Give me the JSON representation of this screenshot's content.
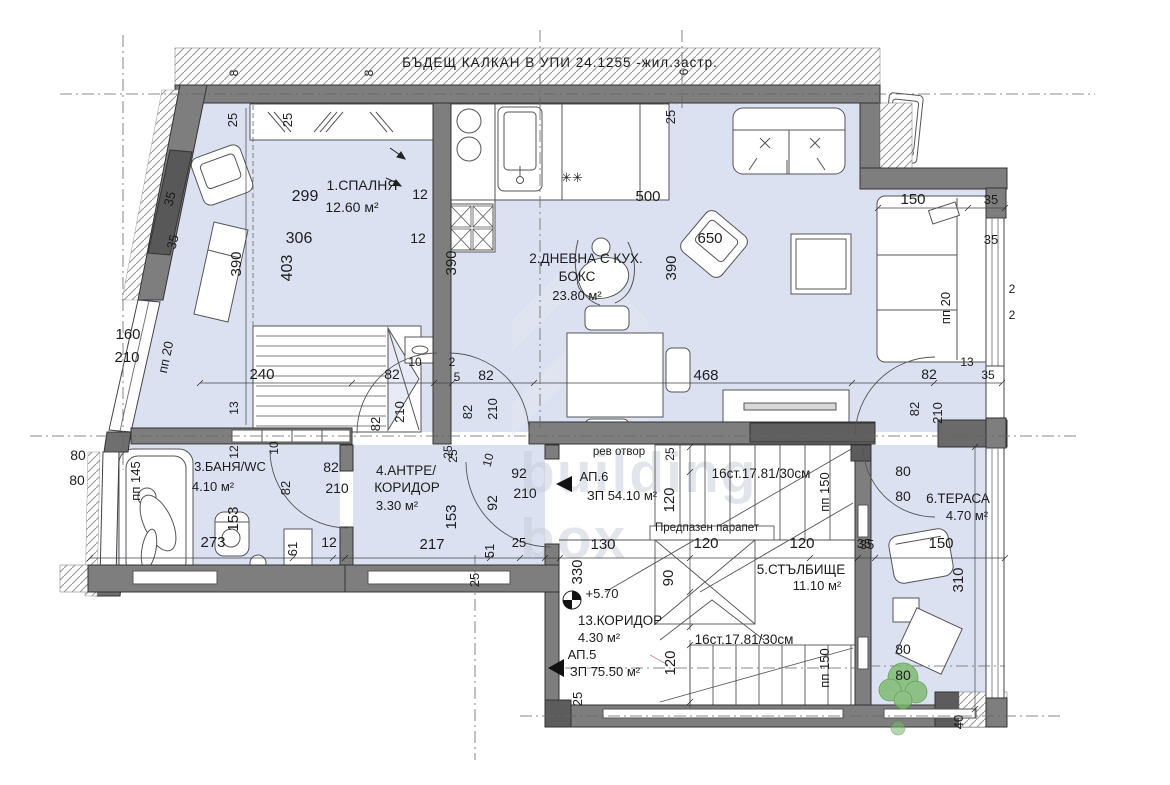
{
  "title": "БЪДЕЩ КАЛКАН В УПИ 24.1255 -жил.застр.",
  "watermark": {
    "line1": "building",
    "line2": "box"
  },
  "labels": [
    {
      "n": "dim-8-a",
      "t": "8",
      "x": 238,
      "y": 73,
      "s": 12,
      "r": -90
    },
    {
      "n": "dim-8-b",
      "t": "8",
      "x": 373,
      "y": 73,
      "s": 12,
      "r": -90
    },
    {
      "n": "dim-6",
      "t": "6",
      "x": 688,
      "y": 72,
      "s": 12,
      "r": -90
    },
    {
      "n": "dim-25-a",
      "t": "25",
      "x": 237,
      "y": 120,
      "s": 13,
      "r": -90
    },
    {
      "n": "dim-25-b",
      "t": "25",
      "x": 292,
      "y": 120,
      "s": 13,
      "r": -90
    },
    {
      "n": "dim-25-c",
      "t": "25",
      "x": 675,
      "y": 117,
      "s": 13,
      "r": -90
    },
    {
      "n": "room1-name",
      "t": "1.СПАЛНЯ",
      "x": 362,
      "y": 190,
      "s": 14,
      "r": 0
    },
    {
      "n": "room1-area",
      "t": "12.60 м²",
      "x": 352,
      "y": 212,
      "s": 14,
      "r": 0
    },
    {
      "n": "dim-299",
      "t": "299",
      "x": 305,
      "y": 201,
      "s": 16,
      "r": 0
    },
    {
      "n": "dim-306",
      "t": "306",
      "x": 299,
      "y": 243,
      "s": 16,
      "r": 0
    },
    {
      "n": "dim-403",
      "t": "403",
      "x": 292,
      "y": 268,
      "s": 16,
      "r": -90
    },
    {
      "n": "dim-390-bed",
      "t": "390",
      "x": 241,
      "y": 264,
      "s": 15,
      "r": -90
    },
    {
      "n": "dim-12-a",
      "t": "12",
      "x": 420,
      "y": 199,
      "s": 14,
      "r": 0
    },
    {
      "n": "dim-12-b",
      "t": "12",
      "x": 418,
      "y": 243,
      "s": 14,
      "r": 0
    },
    {
      "n": "dim-35-a",
      "t": "35",
      "x": 174,
      "y": 200,
      "s": 13,
      "r": -75
    },
    {
      "n": "dim-35-b",
      "t": "35",
      "x": 177,
      "y": 243,
      "s": 13,
      "r": -75
    },
    {
      "n": "dim-160",
      "t": "160",
      "x": 128,
      "y": 339,
      "s": 15,
      "r": 0
    },
    {
      "n": "dim-210-a",
      "t": "210",
      "x": 127,
      "y": 362,
      "s": 15,
      "r": 0
    },
    {
      "n": "dim-pp20-left",
      "t": "пп 20",
      "x": 170,
      "y": 358,
      "s": 13,
      "r": -78
    },
    {
      "n": "dim-240",
      "t": "240",
      "x": 262,
      "y": 379,
      "s": 15,
      "r": 0
    },
    {
      "n": "dim-13-left",
      "t": "13",
      "x": 238,
      "y": 408,
      "s": 12,
      "r": -90
    },
    {
      "n": "dim-12-c",
      "t": "12",
      "x": 238,
      "y": 452,
      "s": 12,
      "r": -90
    },
    {
      "n": "dim-10-a",
      "t": "10",
      "x": 278,
      "y": 448,
      "s": 12,
      "r": -90
    },
    {
      "n": "dim-82-a",
      "t": "82",
      "x": 392,
      "y": 379,
      "s": 14,
      "r": 0
    },
    {
      "n": "dim-82-b",
      "t": "82",
      "x": 380,
      "y": 424,
      "s": 13,
      "r": -90
    },
    {
      "n": "dim-210-b",
      "t": "210",
      "x": 404,
      "y": 412,
      "s": 13,
      "r": -90
    },
    {
      "n": "dim-10-b",
      "t": "10",
      "x": 415,
      "y": 366,
      "s": 12,
      "r": 0
    },
    {
      "n": "dim-2-a",
      "t": "2",
      "x": 452,
      "y": 366,
      "s": 12,
      "r": 0
    },
    {
      "n": "dim-5",
      "t": "5",
      "x": 457,
      "y": 381,
      "s": 12,
      "r": 0
    },
    {
      "n": "dim-82-c",
      "t": "82",
      "x": 486,
      "y": 380,
      "s": 14,
      "r": 0
    },
    {
      "n": "dim-82-d",
      "t": "82",
      "x": 472,
      "y": 412,
      "s": 13,
      "r": -90
    },
    {
      "n": "dim-210-c",
      "t": "210",
      "x": 497,
      "y": 409,
      "s": 13,
      "r": -90
    },
    {
      "n": "dim-25-d",
      "t": "25",
      "x": 452,
      "y": 452,
      "s": 12,
      "r": -90
    },
    {
      "n": "dim-390-kitchen",
      "t": "390",
      "x": 456,
      "y": 263,
      "s": 15,
      "r": -90
    },
    {
      "n": "dim-500",
      "t": "500",
      "x": 648,
      "y": 201,
      "s": 15,
      "r": 0
    },
    {
      "n": "dim-650",
      "t": "650",
      "x": 710,
      "y": 243,
      "s": 15,
      "r": 0
    },
    {
      "n": "room2-name1",
      "t": "2.ДНЕВНА С КУХ.",
      "x": 586,
      "y": 263,
      "s": 13.5,
      "r": 0
    },
    {
      "n": "room2-name2",
      "t": "БОКС",
      "x": 577,
      "y": 281,
      "s": 13.5,
      "r": 0
    },
    {
      "n": "room2-area",
      "t": "23.80 м²",
      "x": 577,
      "y": 300,
      "s": 13,
      "r": 0
    },
    {
      "n": "dim-390-living",
      "t": "390",
      "x": 676,
      "y": 268,
      "s": 15,
      "r": -90
    },
    {
      "n": "dim-468",
      "t": "468",
      "x": 706,
      "y": 380,
      "s": 15,
      "r": 0
    },
    {
      "n": "cooktop-marks",
      "t": "✳✳",
      "x": 572,
      "y": 182,
      "s": 13,
      "r": 0
    },
    {
      "n": "dim-150-sofa",
      "t": "150",
      "x": 913,
      "y": 204,
      "s": 15,
      "r": 0
    },
    {
      "n": "dim-35-c",
      "t": "35",
      "x": 991,
      "y": 204,
      "s": 13,
      "r": 0
    },
    {
      "n": "dim-35-d",
      "t": "35",
      "x": 991,
      "y": 244,
      "s": 13,
      "r": 0
    },
    {
      "n": "dim-pp20-right",
      "t": "пп 20",
      "x": 950,
      "y": 308,
      "s": 13,
      "r": -90
    },
    {
      "n": "dim-2-b",
      "t": "2",
      "x": 1012,
      "y": 293,
      "s": 12,
      "r": 0
    },
    {
      "n": "dim-2-c",
      "t": "2",
      "x": 1012,
      "y": 319,
      "s": 12,
      "r": 0
    },
    {
      "n": "dim-13-right",
      "t": "13",
      "x": 967,
      "y": 366,
      "s": 12,
      "r": 0
    },
    {
      "n": "dim-35-e",
      "t": "35",
      "x": 988,
      "y": 379,
      "s": 12,
      "r": 0
    },
    {
      "n": "dim-82-e",
      "t": "82",
      "x": 929,
      "y": 379,
      "s": 14,
      "r": 0
    },
    {
      "n": "dim-82-f",
      "t": "82",
      "x": 919,
      "y": 409,
      "s": 13,
      "r": -90
    },
    {
      "n": "dim-210-d",
      "t": "210",
      "x": 942,
      "y": 413,
      "s": 13,
      "r": -90
    },
    {
      "n": "dim-80-a",
      "t": "80",
      "x": 78,
      "y": 460,
      "s": 14,
      "r": 0
    },
    {
      "n": "dim-80-b",
      "t": "80",
      "x": 77,
      "y": 485,
      "s": 14,
      "r": 0
    },
    {
      "n": "room3-name",
      "t": "3.БАНЯ/WC",
      "x": 230,
      "y": 471,
      "s": 13,
      "r": 0
    },
    {
      "n": "room3-area",
      "t": "4.10 м²",
      "x": 213,
      "y": 491,
      "s": 13,
      "r": 0
    },
    {
      "n": "dim-pp145",
      "t": "пп 145",
      "x": 140,
      "y": 481,
      "s": 13,
      "r": -90
    },
    {
      "n": "dim-153-bath",
      "t": "153",
      "x": 238,
      "y": 519,
      "s": 15,
      "r": -90
    },
    {
      "n": "dim-273",
      "t": "273",
      "x": 213,
      "y": 547,
      "s": 15,
      "r": 0
    },
    {
      "n": "dim-61",
      "t": "61",
      "x": 297,
      "y": 549,
      "s": 13,
      "r": -90
    },
    {
      "n": "dim-12-d",
      "t": "12",
      "x": 329,
      "y": 547,
      "s": 14,
      "r": 0
    },
    {
      "n": "dim-82-g",
      "t": "82",
      "x": 290,
      "y": 488,
      "s": 13,
      "r": -90
    },
    {
      "n": "dim-82-h",
      "t": "82",
      "x": 331,
      "y": 472,
      "s": 14,
      "r": 0
    },
    {
      "n": "dim-210-e",
      "t": "210",
      "x": 337,
      "y": 493,
      "s": 14,
      "r": 0
    },
    {
      "n": "room4-name1",
      "t": "4.АНТРЕ/",
      "x": 406,
      "y": 475,
      "s": 13.5,
      "r": 0
    },
    {
      "n": "room4-name2",
      "t": "КОРИДОР",
      "x": 407,
      "y": 492,
      "s": 13.5,
      "r": 0
    },
    {
      "n": "room4-area",
      "t": "3.30 м²",
      "x": 397,
      "y": 510,
      "s": 13,
      "r": 0
    },
    {
      "n": "dim-25-e",
      "t": "25",
      "x": 457,
      "y": 456,
      "s": 12,
      "r": -90
    },
    {
      "n": "dim-10-c",
      "t": "10",
      "x": 492,
      "y": 461,
      "s": 12,
      "r": -75
    },
    {
      "n": "dim-153-hall",
      "t": "153",
      "x": 456,
      "y": 517,
      "s": 15,
      "r": -90
    },
    {
      "n": "dim-92-a",
      "t": "92",
      "x": 519,
      "y": 478,
      "s": 14,
      "r": 0
    },
    {
      "n": "dim-210-f",
      "t": "210",
      "x": 525,
      "y": 498,
      "s": 14,
      "r": 0
    },
    {
      "n": "dim-92-b",
      "t": "92",
      "x": 497,
      "y": 503,
      "s": 14,
      "r": -90
    },
    {
      "n": "dim-217",
      "t": "217",
      "x": 432,
      "y": 549,
      "s": 15,
      "r": 0
    },
    {
      "n": "dim-51",
      "t": "51",
      "x": 494,
      "y": 551,
      "s": 13,
      "r": -90
    },
    {
      "n": "dim-25-f",
      "t": "25",
      "x": 519,
      "y": 547,
      "s": 13,
      "r": 0
    },
    {
      "n": "dim-25-g",
      "t": "25",
      "x": 479,
      "y": 580,
      "s": 13,
      "r": -90
    },
    {
      "n": "rev-otvor",
      "t": "рев отвор",
      "x": 619,
      "y": 455,
      "s": 11.5,
      "r": 0
    },
    {
      "n": "ap6-name",
      "t": "АП.6",
      "x": 594,
      "y": 481,
      "s": 13,
      "r": 0
    },
    {
      "n": "ap6-area",
      "t": "ЗП 54.10 м²",
      "x": 622,
      "y": 500,
      "s": 13,
      "r": 0
    },
    {
      "n": "stairs-upper-note",
      "t": "16ст.17.81/30см",
      "x": 761,
      "y": 478,
      "s": 13.5,
      "r": 0
    },
    {
      "n": "railing-note",
      "t": "Предпазен парапет",
      "x": 707,
      "y": 531,
      "s": 11.5,
      "r": 0
    },
    {
      "n": "dim-25-h",
      "t": "25",
      "x": 674,
      "y": 454,
      "s": 12,
      "r": -90
    },
    {
      "n": "dim-120-a",
      "t": "120",
      "x": 674,
      "y": 500,
      "s": 15,
      "r": -90
    },
    {
      "n": "dim-pp150-a",
      "t": "пп 150",
      "x": 829,
      "y": 492,
      "s": 13,
      "r": -90
    },
    {
      "n": "dim-130",
      "t": "130",
      "x": 603,
      "y": 549,
      "s": 15,
      "r": 0
    },
    {
      "n": "dim-120-b",
      "t": "120",
      "x": 706,
      "y": 548,
      "s": 15,
      "r": 0
    },
    {
      "n": "dim-120-c",
      "t": "120",
      "x": 802,
      "y": 548,
      "s": 15,
      "r": 0
    },
    {
      "n": "dim-35-f",
      "t": "35",
      "x": 867,
      "y": 549,
      "s": 13,
      "r": 0
    },
    {
      "n": "dim-330",
      "t": "330",
      "x": 582,
      "y": 572,
      "s": 15,
      "r": -90
    },
    {
      "n": "dim-90",
      "t": "90",
      "x": 673,
      "y": 578,
      "s": 15,
      "r": -90
    },
    {
      "n": "room5-name",
      "t": "5.СТЪЛБИЩЕ",
      "x": 801,
      "y": 574,
      "s": 13.5,
      "r": 0
    },
    {
      "n": "room5-area",
      "t": "11.10 м²",
      "x": 817,
      "y": 590,
      "s": 13,
      "r": 0
    },
    {
      "n": "level-mark-value",
      "t": "+5.70",
      "x": 602,
      "y": 598,
      "s": 13,
      "r": 0
    },
    {
      "n": "room13-name",
      "t": "13.КОРИДОР",
      "x": 620,
      "y": 625,
      "s": 13.5,
      "r": 0
    },
    {
      "n": "room13-area",
      "t": "4.30 м²",
      "x": 599,
      "y": 642,
      "s": 13,
      "r": 0
    },
    {
      "n": "ap5-name",
      "t": "АП.5",
      "x": 582,
      "y": 659,
      "s": 13,
      "r": 0
    },
    {
      "n": "ap5-area",
      "t": "ЗП 75.50 м²",
      "x": 605,
      "y": 676,
      "s": 13,
      "r": 0
    },
    {
      "n": "stairs-lower-note",
      "t": "16ст.17.81/30см",
      "x": 744,
      "y": 644,
      "s": 13.5,
      "r": 0
    },
    {
      "n": "dim-120-d",
      "t": "120",
      "x": 675,
      "y": 663,
      "s": 15,
      "r": -90
    },
    {
      "n": "dim-pp150-b",
      "t": "пп 150",
      "x": 829,
      "y": 668,
      "s": 13,
      "r": -90
    },
    {
      "n": "dim-25-i",
      "t": "25",
      "x": 582,
      "y": 699,
      "s": 13,
      "r": -90
    },
    {
      "n": "room6-name",
      "t": "6.ТЕРАСА",
      "x": 958,
      "y": 503,
      "s": 13.5,
      "r": 0
    },
    {
      "n": "room6-area",
      "t": "4.70 м²",
      "x": 967,
      "y": 520,
      "s": 13,
      "r": 0
    },
    {
      "n": "dim-80-c",
      "t": "80",
      "x": 903,
      "y": 476,
      "s": 14,
      "r": 0
    },
    {
      "n": "dim-80-d",
      "t": "80",
      "x": 903,
      "y": 501,
      "s": 14,
      "r": 0
    },
    {
      "n": "dim-150-terrace",
      "t": "150",
      "x": 941,
      "y": 548,
      "s": 15,
      "r": 0
    },
    {
      "n": "dim-310",
      "t": "310",
      "x": 963,
      "y": 580,
      "s": 15,
      "r": -90
    },
    {
      "n": "dim-35-g",
      "t": "35",
      "x": 864,
      "y": 548,
      "s": 13,
      "r": 0
    },
    {
      "n": "dim-80-e",
      "t": "80",
      "x": 903,
      "y": 654,
      "s": 14,
      "r": 0
    },
    {
      "n": "dim-80-f",
      "t": "80",
      "x": 903,
      "y": 680,
      "s": 14,
      "r": 0
    },
    {
      "n": "dim-40",
      "t": "40",
      "x": 963,
      "y": 722,
      "s": 13,
      "r": -90
    }
  ]
}
